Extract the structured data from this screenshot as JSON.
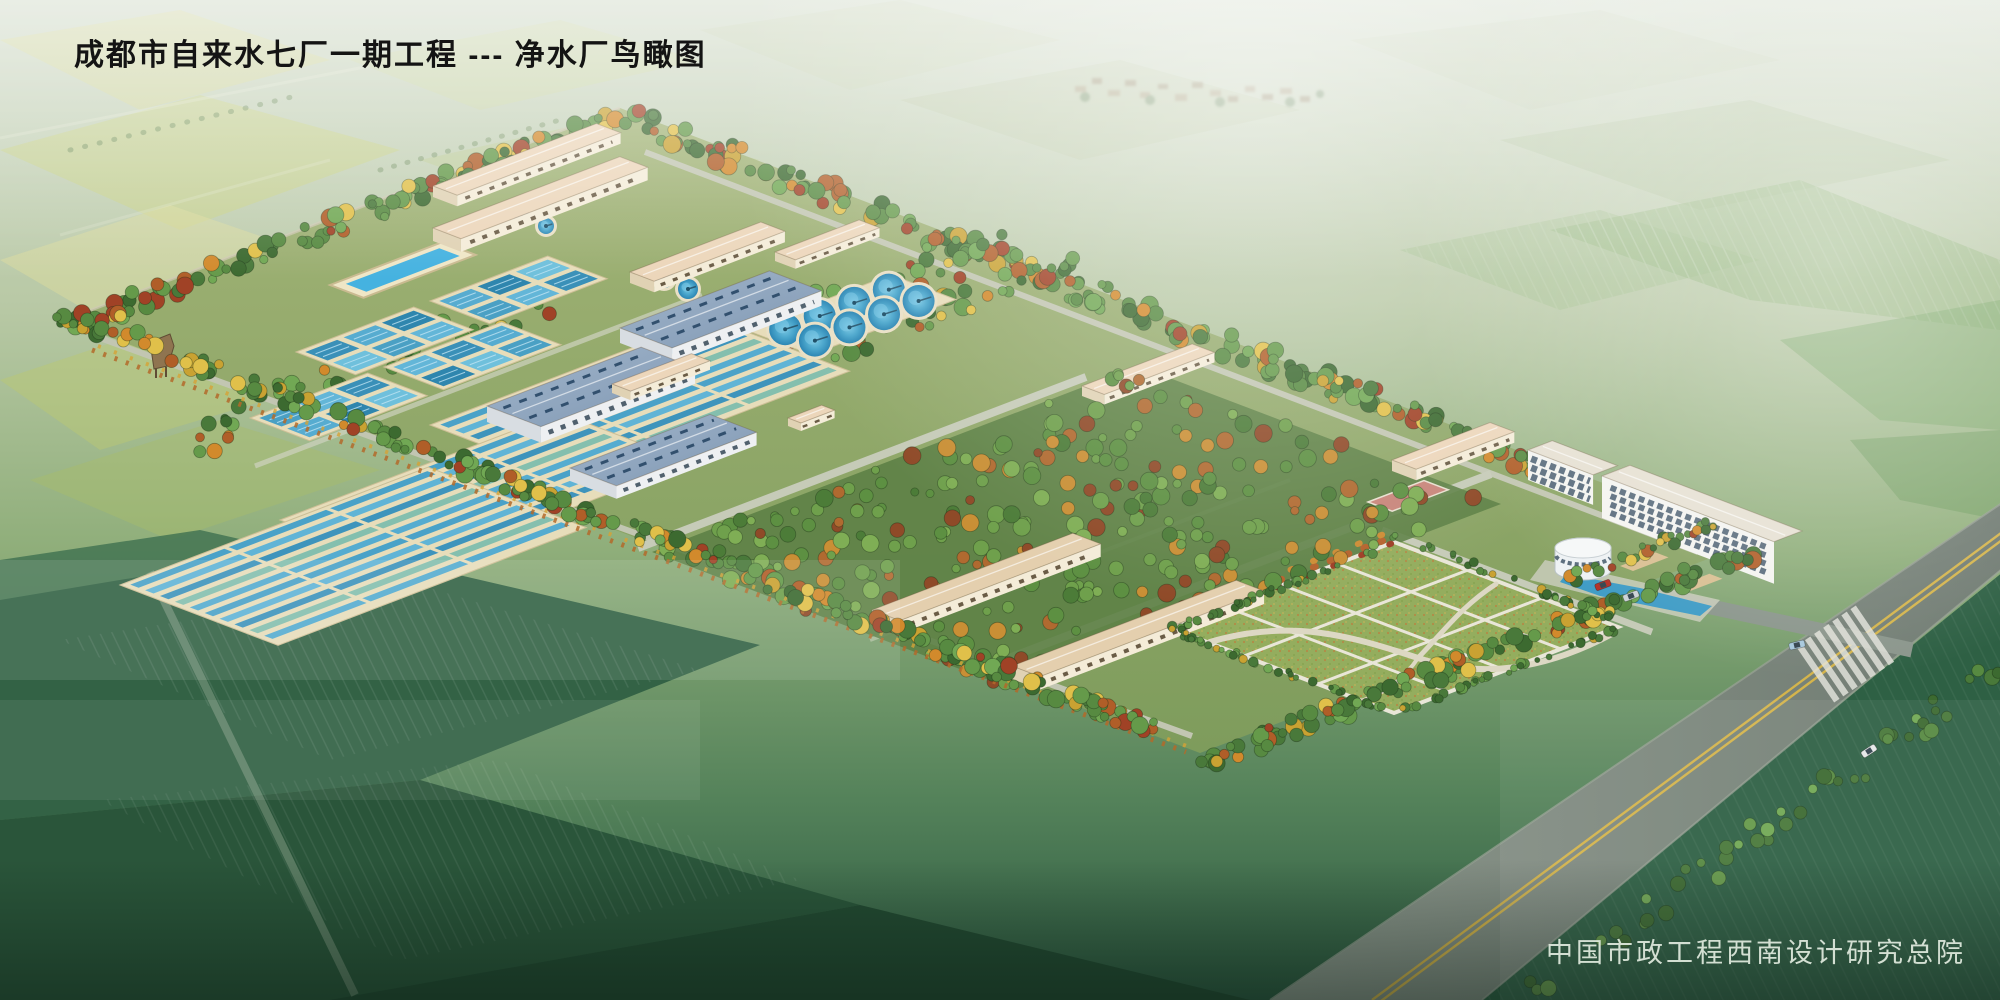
{
  "title": "成都市自来水七厂一期工程 --- 净水厂鸟瞰图",
  "credit": "中国市政工程西南设计研究总院",
  "scene": {
    "clarifier_tanks": 8,
    "small_round_tanks": 4,
    "palette": {
      "water": "#3f9cc6",
      "water_light": "#6fc2e0",
      "basin_wall": "#e7ddba",
      "metal_roof": "#8ea6c0",
      "building_wall": "#f4ecd8",
      "tile_roof": "#ecd6ba",
      "tree_green": "#4c7d3a",
      "tree_autumn": "#c9812e",
      "lawn": "#94ad5e",
      "road": "#7e8a80",
      "road_line": "#d4b44c",
      "field_dark": "#2e5d40",
      "haze": "#cdd8c4"
    }
  }
}
